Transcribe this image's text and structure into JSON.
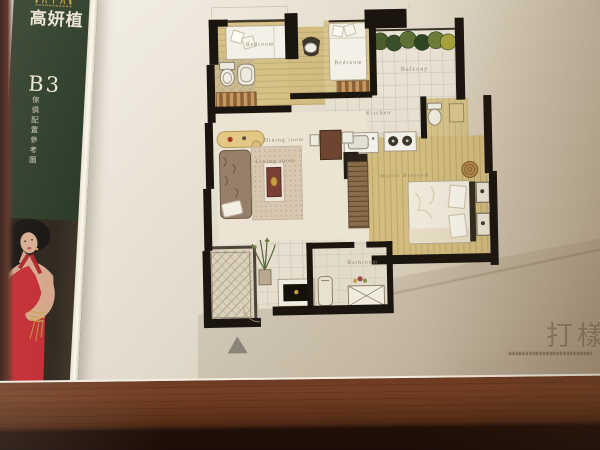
{
  "brand": {
    "name": "高妍植",
    "unit_label": "B3",
    "unit_subtitle": "傢俱配置參考圖"
  },
  "floorplan": {
    "labels": {
      "bedroom_top_left": "Bedroom",
      "bedroom_top_mid": "Bedroom",
      "balcony": "Balcony",
      "kitchen": "Kitchen",
      "dining_room": "Dining room",
      "living_room": "Living room",
      "master_bedroom": "Master Bedroom",
      "bathroom": "Bathroom"
    },
    "entrance_marker_icon": "triangle-up"
  },
  "watermark": {
    "text": "打樣"
  },
  "colors": {
    "spine_green": "#24351f",
    "dress_red": "#c02128",
    "gold": "#c9a23f",
    "wall_black": "#1b150f",
    "wood_floor": "#d5c089",
    "paper_cream": "#ece5d5",
    "table_brown": "#5e3320"
  }
}
